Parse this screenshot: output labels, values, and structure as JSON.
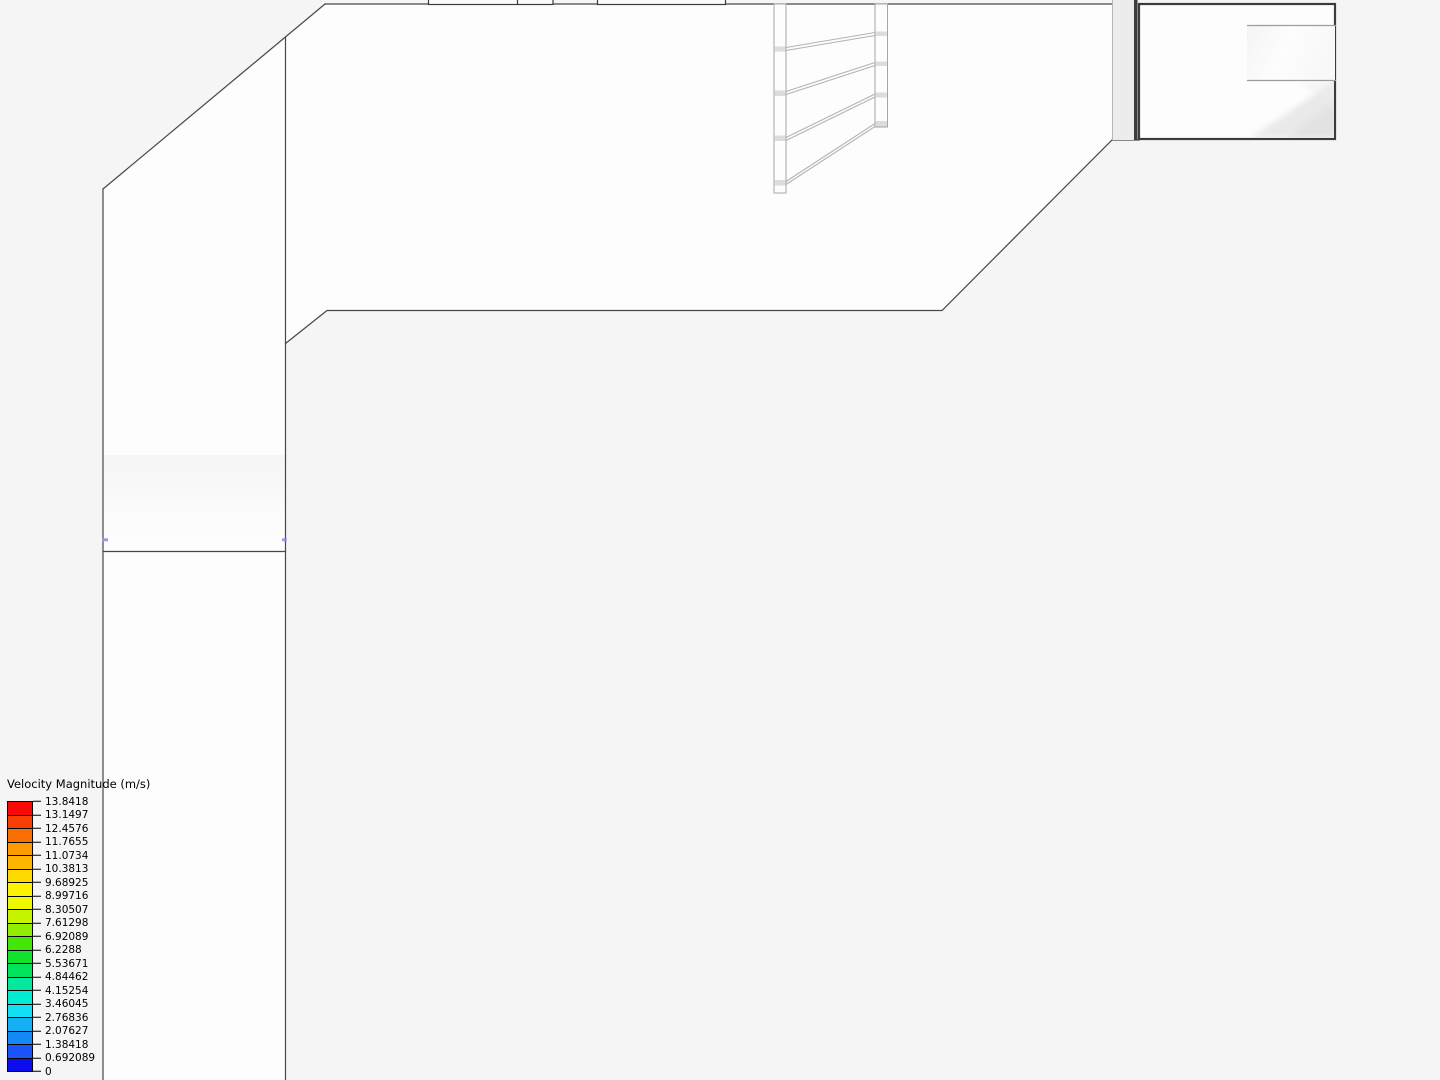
{
  "legend": {
    "title": "Velocity Magnitude (m/s)",
    "tick_labels": [
      "13.8418",
      "13.1497",
      "12.4576",
      "11.7655",
      "11.0734",
      "10.3813",
      "9.68925",
      "8.99716",
      "8.30507",
      "7.61298",
      "6.92089",
      "6.2288",
      "5.53671",
      "4.84462",
      "4.15254",
      "3.46045",
      "2.76836",
      "2.07627",
      "1.38418",
      "0.692089",
      "0"
    ],
    "band_colors": [
      "#f90a06",
      "#f83e03",
      "#fa6f02",
      "#fb9a01",
      "#fcb601",
      "#fdd801",
      "#fdf201",
      "#eef900",
      "#c6f400",
      "#8fee01",
      "#44e607",
      "#12e22c",
      "#02e25b",
      "#04e79e",
      "#00ecd3",
      "#12dff4",
      "#15b0f3",
      "#1488f5",
      "#1b55fa",
      "#0b0cf0"
    ]
  },
  "scene": {
    "background_color": "#f5f5f5",
    "surface_color": "#fdfdfd",
    "edge_color": "#474747",
    "frame_color": "#3c3c3c",
    "rail_color": "#b3b3b3",
    "post_edge_color": "#a5a5a5",
    "wall_column_color": "#ececec",
    "marker_color": "#8b8be0"
  }
}
